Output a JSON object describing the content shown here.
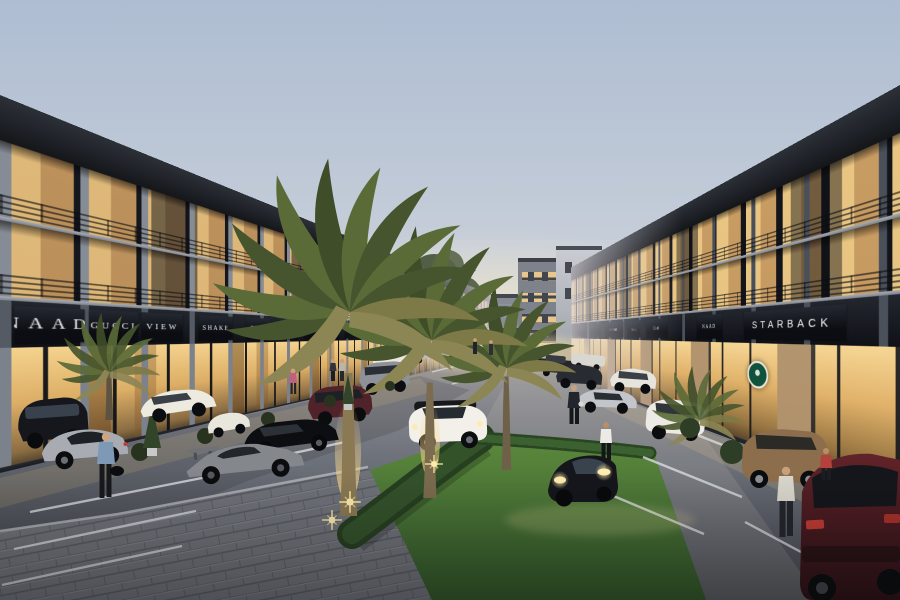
{
  "scene": {
    "title": "Twilight 3D rendering of a modern shophouse shopping street",
    "setting": "Two rows of three-storey shophouses with lit shopfronts face a palm-lined parking street at dusk",
    "time_of_day": "dusk"
  },
  "left_building": {
    "signs": [
      "NAAD",
      "GUCCI",
      "VIEW",
      "SHAKE",
      "TEXT",
      "SEXT",
      "FILM"
    ]
  },
  "right_building": {
    "signs_far_to_near": [
      "MINI MART",
      "Gucci",
      "Cool",
      "NAAD",
      "STARBACK"
    ],
    "logo": "green circular coffee-house emblem beside STARBACK shopfront"
  },
  "street": {
    "features": [
      "angled parking bays with white stall lines",
      "date palms with warm uplights",
      "clipped hedges",
      "paver plaza corner",
      "lawn wedge",
      "background shophouse block with stair tower"
    ],
    "vehicles": [
      {
        "type": "dark mpv",
        "color": "#15171c"
      },
      {
        "type": "white sedan",
        "color": "#edebdf"
      },
      {
        "type": "silver coupe",
        "color": "#a8abb1"
      },
      {
        "type": "black sedan",
        "color": "#0c0e12"
      },
      {
        "type": "grey lamborghini with wing",
        "color": "#84878c"
      },
      {
        "type": "maroon suv",
        "color": "#4f2329"
      },
      {
        "type": "white mini crossover",
        "color": "#f2f0e9"
      },
      {
        "type": "black sports car, headlights on",
        "color": "#14161c"
      },
      {
        "type": "silver sports car",
        "color": "#c2c5ca"
      },
      {
        "type": "white suv",
        "color": "#eceae4"
      },
      {
        "type": "tan sedan",
        "color": "#8d6e4c"
      },
      {
        "type": "dark red suv rear",
        "color": "#5a2126"
      }
    ],
    "people": [
      "man with duffel bag",
      "woman in white top",
      "pedestrian in dark clothes",
      "couple beside red suv",
      "distant shoppers"
    ]
  },
  "palette": {
    "sky_top": "#aebdd2",
    "sky_horizon": "#f1e6cd",
    "building_frame": "#23262c",
    "window_glow": "#ecc27c",
    "sign_band": "#0f1117",
    "sign_text": "#f1f1f3",
    "logo_green": "#11523c",
    "grass": "#4d7a35",
    "asphalt": "#70747d",
    "paver": "#6f7278"
  }
}
